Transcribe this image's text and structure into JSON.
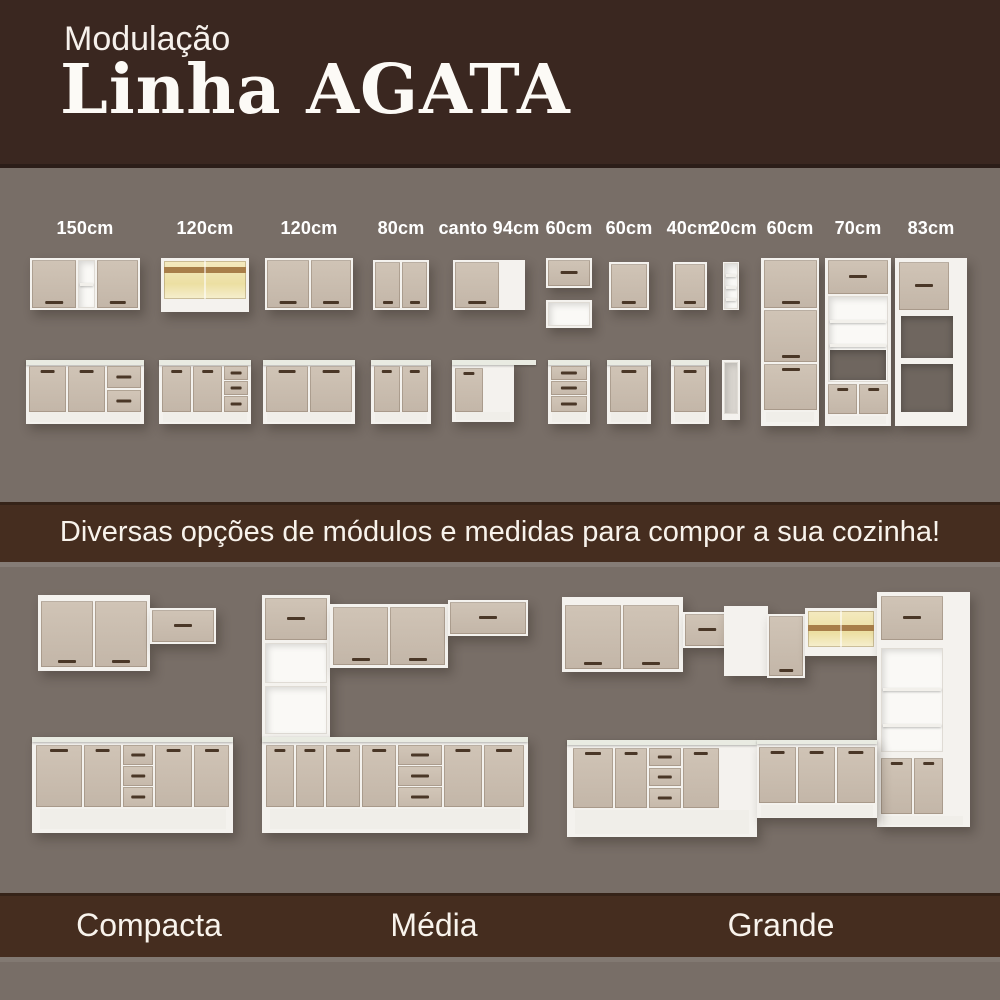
{
  "header": {
    "eyebrow": "Modulação",
    "title": "Linha AGATA"
  },
  "modules": {
    "labels": [
      "150cm",
      "120cm",
      "120cm",
      "80cm",
      "canto 94cm",
      "60cm",
      "60cm",
      "40cm",
      "20cm",
      "60cm",
      "70cm",
      "83cm"
    ]
  },
  "banner": {
    "text": "Diversas opções de módulos e medidas para compor a sua cozinha!"
  },
  "kitchens": {
    "labels": [
      "Compacta",
      "Média",
      "Grande"
    ]
  },
  "colors": {
    "header_bg": "#3A2720",
    "band_bg": "#452D1F",
    "section_bg": "#786E67",
    "door_beige": "#C9BCAE",
    "carcass_white": "#F4F2EE",
    "handle_brown": "#4A3727",
    "glass_yellow": "#EFE3AC",
    "wood_strip": "#A87E49",
    "countertop": "#E9EBE2",
    "text_white": "#FFFFFF"
  }
}
